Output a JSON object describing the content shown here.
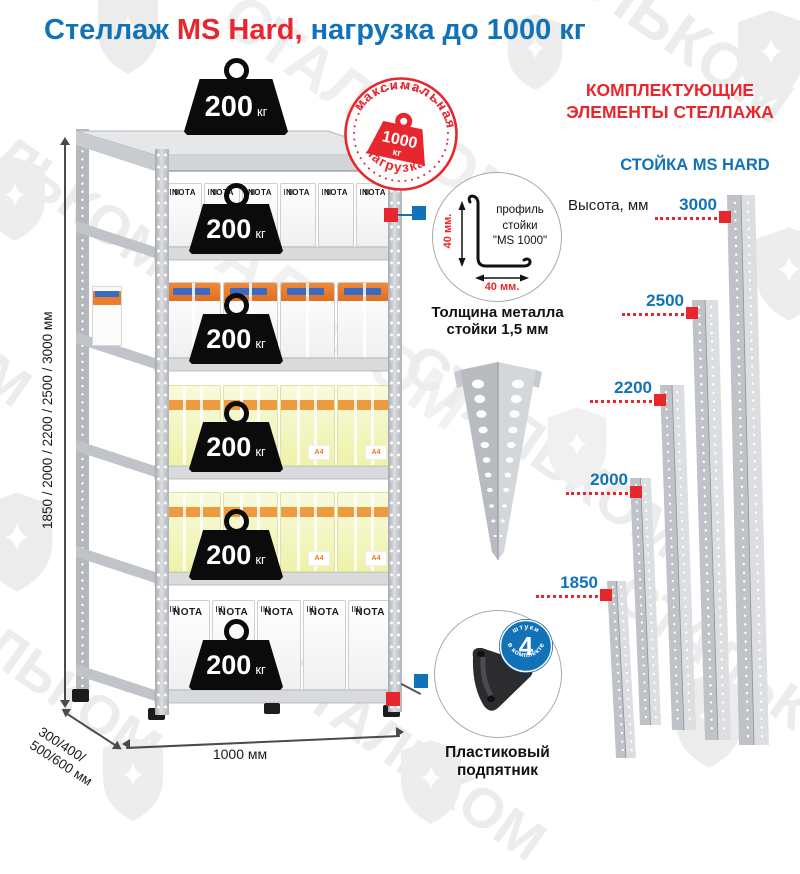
{
  "title": {
    "part1": "Стеллаж ",
    "part2": "MS Hard,",
    "part3": " нагрузка до 1000 кг"
  },
  "badge": {
    "arc_top": "максимальная",
    "arc_bottom": "нагрузка",
    "weight_value": "1000",
    "weight_unit": "кг"
  },
  "rack": {
    "weight_value": "200",
    "weight_unit": "кг",
    "box_brand": "NOTA",
    "a4_label": "A4"
  },
  "dimensions": {
    "heights": "1850 / 2000 / 2200 / 2500 / 3000 мм",
    "depth_line1": "300/400/",
    "depth_line2": "500/600 мм",
    "width": "1000 мм"
  },
  "details": {
    "profile": {
      "line1": "профиль",
      "line2": "стойки",
      "line3": "\"MS 1000\"",
      "dim_vertical": "40 мм.",
      "dim_horizontal": "40 мм."
    },
    "thickness_line1": "Толщина металла",
    "thickness_line2": "стойки 1,5 мм",
    "foot": {
      "label_line1": "Пластиковый",
      "label_line2": "подпятник",
      "badge_count": "4",
      "badge_arc_top": "штуки",
      "badge_arc_bottom": "в комплекте"
    }
  },
  "components": {
    "header_line1": "КОМПЛЕКТУЮЩИЕ",
    "header_line2": "ЭЛЕМЕНТЫ СТЕЛЛАЖА",
    "subheader": "СТОЙКА MS HARD",
    "height_label": "Высота, мм",
    "stands": [
      {
        "value": "3000"
      },
      {
        "value": "2500"
      },
      {
        "value": "2200"
      },
      {
        "value": "2000"
      },
      {
        "value": "1850"
      }
    ]
  },
  "watermark": {
    "text": "СТАЛЬКОМ"
  },
  "colors": {
    "blue": "#1272b8",
    "red": "#e8262d"
  }
}
